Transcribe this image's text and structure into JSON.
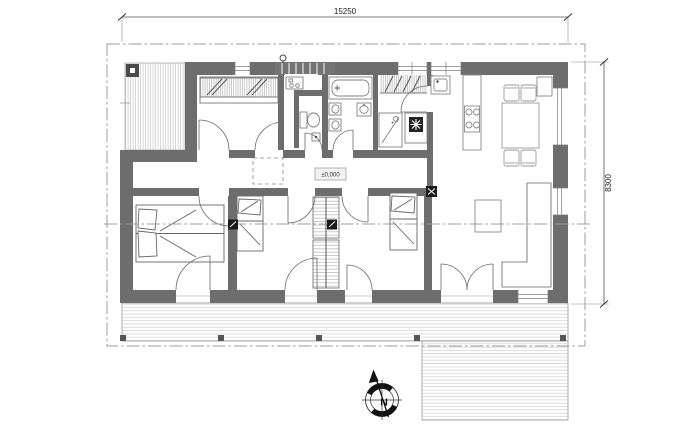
{
  "meta": {
    "type": "architectural-floor-plan",
    "view": "single-storey house ground plan"
  },
  "texts": {
    "dim_width": "15250",
    "dim_height": "8300",
    "level": "±0,000",
    "compass_north": "N"
  },
  "colors": {
    "wall": "#6d6d6d",
    "background": "#ffffff",
    "boundary_line": "#9c9c9c",
    "furniture_line": "#848484",
    "deck_line": "#d4d4d4",
    "accent_black": "#1a1a1a"
  },
  "icons": [
    "compass-rose",
    "north-arrow",
    "bathtub-icon",
    "toilet-icon",
    "washbasin-icon",
    "shower-icon",
    "heat-unit-fan-icon",
    "kitchen-sink-icon",
    "cooktop-icon",
    "fridge-icon",
    "dining-table",
    "chair",
    "double-bed",
    "single-bed",
    "wardrobe",
    "sofa",
    "coffee-table",
    "stove-icon",
    "entry-lamp-icon",
    "shoe-cabinet-icon",
    "drain-icon",
    "section-marker",
    "deck-post",
    "attic-hatch",
    "level-marker"
  ]
}
